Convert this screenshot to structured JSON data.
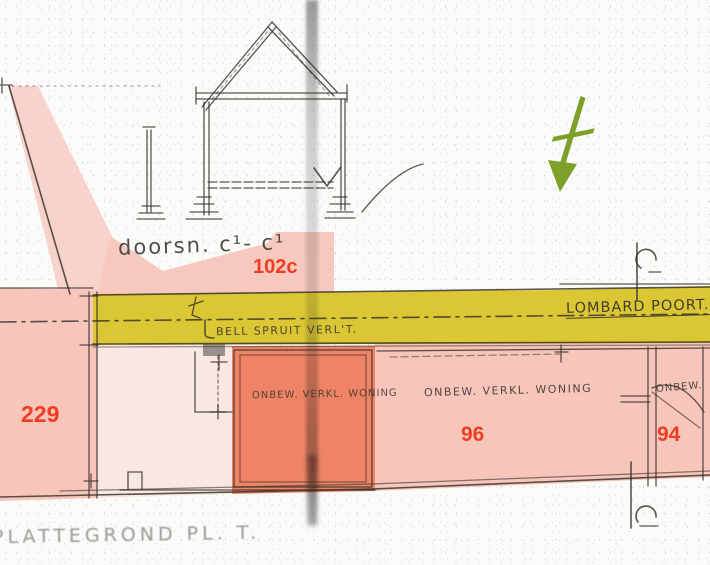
{
  "drawing": {
    "section_label": "doorsn. c¹- c¹",
    "street_name": "LOMBARD POORT.",
    "street_note": "BELL SPRUIT VERL'T.",
    "bottom_caption": "PLATTEGROND  PL. T.",
    "labels": {
      "building_102c": "102c",
      "parcel_229": "229",
      "parcel_96": "96",
      "parcel_94": "94"
    },
    "annotations": {
      "dark_block": "onbew. verkl. woning",
      "right_block": "onbew. verkl. woning",
      "right_edge_partial": "onbew."
    },
    "colors": {
      "highlight_yellow": "#dbc734",
      "highlight_pink": "#f7c5ba",
      "highlight_pink_dark": "#ee8465",
      "highlight_pink_light": "#f9e7e3",
      "highlight_pink_wedge": "#f8d3cc",
      "highlight_pink_block102c": "#f6c8be",
      "label_red": "#ee3d22",
      "arrow_green": "#7da02b"
    },
    "icons": [
      "north-arrow-icon",
      "section-marker-top",
      "section-marker-bottom"
    ]
  }
}
